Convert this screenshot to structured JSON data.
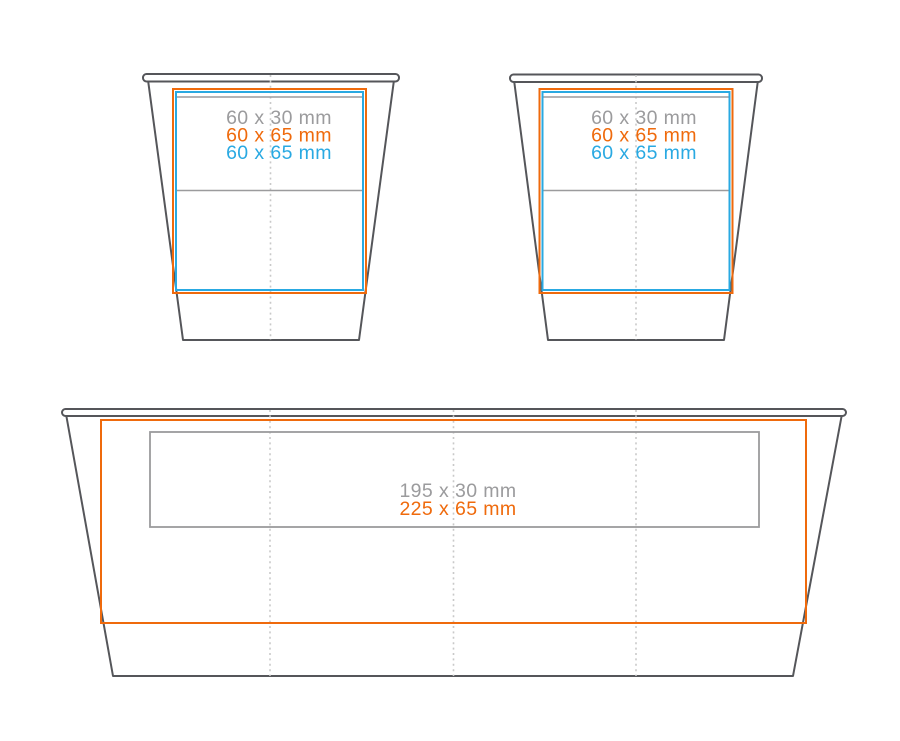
{
  "colors": {
    "outline": "#55565A",
    "gray": "#9B9B9D",
    "orange": "#EF6A0C",
    "blue": "#29A9E2",
    "dash": "#C9C9C9",
    "bg": "#FFFFFF"
  },
  "cup_left": {
    "label_gray": "60 x 30 mm",
    "label_orange": "60 x 65 mm",
    "label_blue": "60 x 65 mm"
  },
  "cup_right": {
    "label_gray": "60 x 30 mm",
    "label_orange": "60 x 65 mm",
    "label_blue": "60 x 65 mm"
  },
  "tray": {
    "label_gray": "195 x 30 mm",
    "label_orange": "225 x 65 mm"
  }
}
